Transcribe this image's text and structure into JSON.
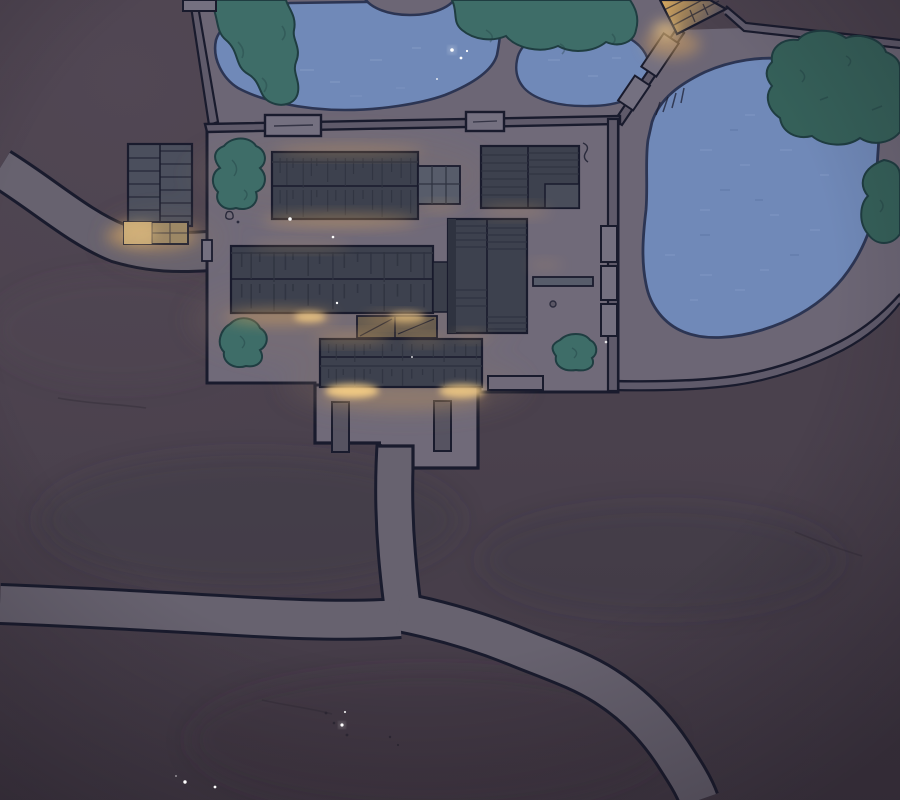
{
  "scene": {
    "description": "Night-time aerial (top-down) illustrated view of a walled estate: a central courtyard compound with dark tiled halls and warm lantern light under the eaves, garden ponds to the north and east, dark teal trees, an outer storehouse to the west, gate pillars and a forecourt to the south, and pale winding footpaths crossing dark purple-brown grounds.",
    "time_of_day": "night"
  },
  "colors": {
    "ink": "#191b2d",
    "water_ink": "#2c3553",
    "ground": "#4a414d",
    "ground_light": "#574c59",
    "ground_dark": "#3d3540",
    "garden": "#6c6675",
    "court": "#706a79",
    "path": "#67626f",
    "wall": "#5f5a6a",
    "gate": "#747080",
    "roof": "#3d414e",
    "roof_dark": "#2f3340",
    "roof_light": "#575c6a",
    "roof_store": "#4b4f5d",
    "pillar": "#565361",
    "deck": "#675c4f",
    "porch": "#a08b66",
    "porch_bright": "#cfb07a",
    "tree": "#3e6d68",
    "tree_ink": "#1f3d41",
    "tree_dark": "#356059",
    "water": "#7089b8",
    "water_light": "#93a9d2",
    "glow": "#d4a05d",
    "glow_bright": "#f6cd84",
    "building_lit": "#dcab5f",
    "star": "#ffffff",
    "speck": "#2b2632"
  },
  "elements": {
    "north_pond": "large garden pond, top center",
    "second_pond": "small oval pond, top right of center",
    "east_pond": "large walled pond garden, right side",
    "compound": "central walled courtyard with tiled halls",
    "storehouse": "outer storehouse with lit porch, west",
    "lit_building": "lantern-lit outbuilding, top right",
    "forecourt": "south gate forecourt with two pillars",
    "paths": "pale footpaths running west, south and southeast",
    "trees": "dark teal tree clusters",
    "sparkles": "tiny white glints on water and ground"
  }
}
